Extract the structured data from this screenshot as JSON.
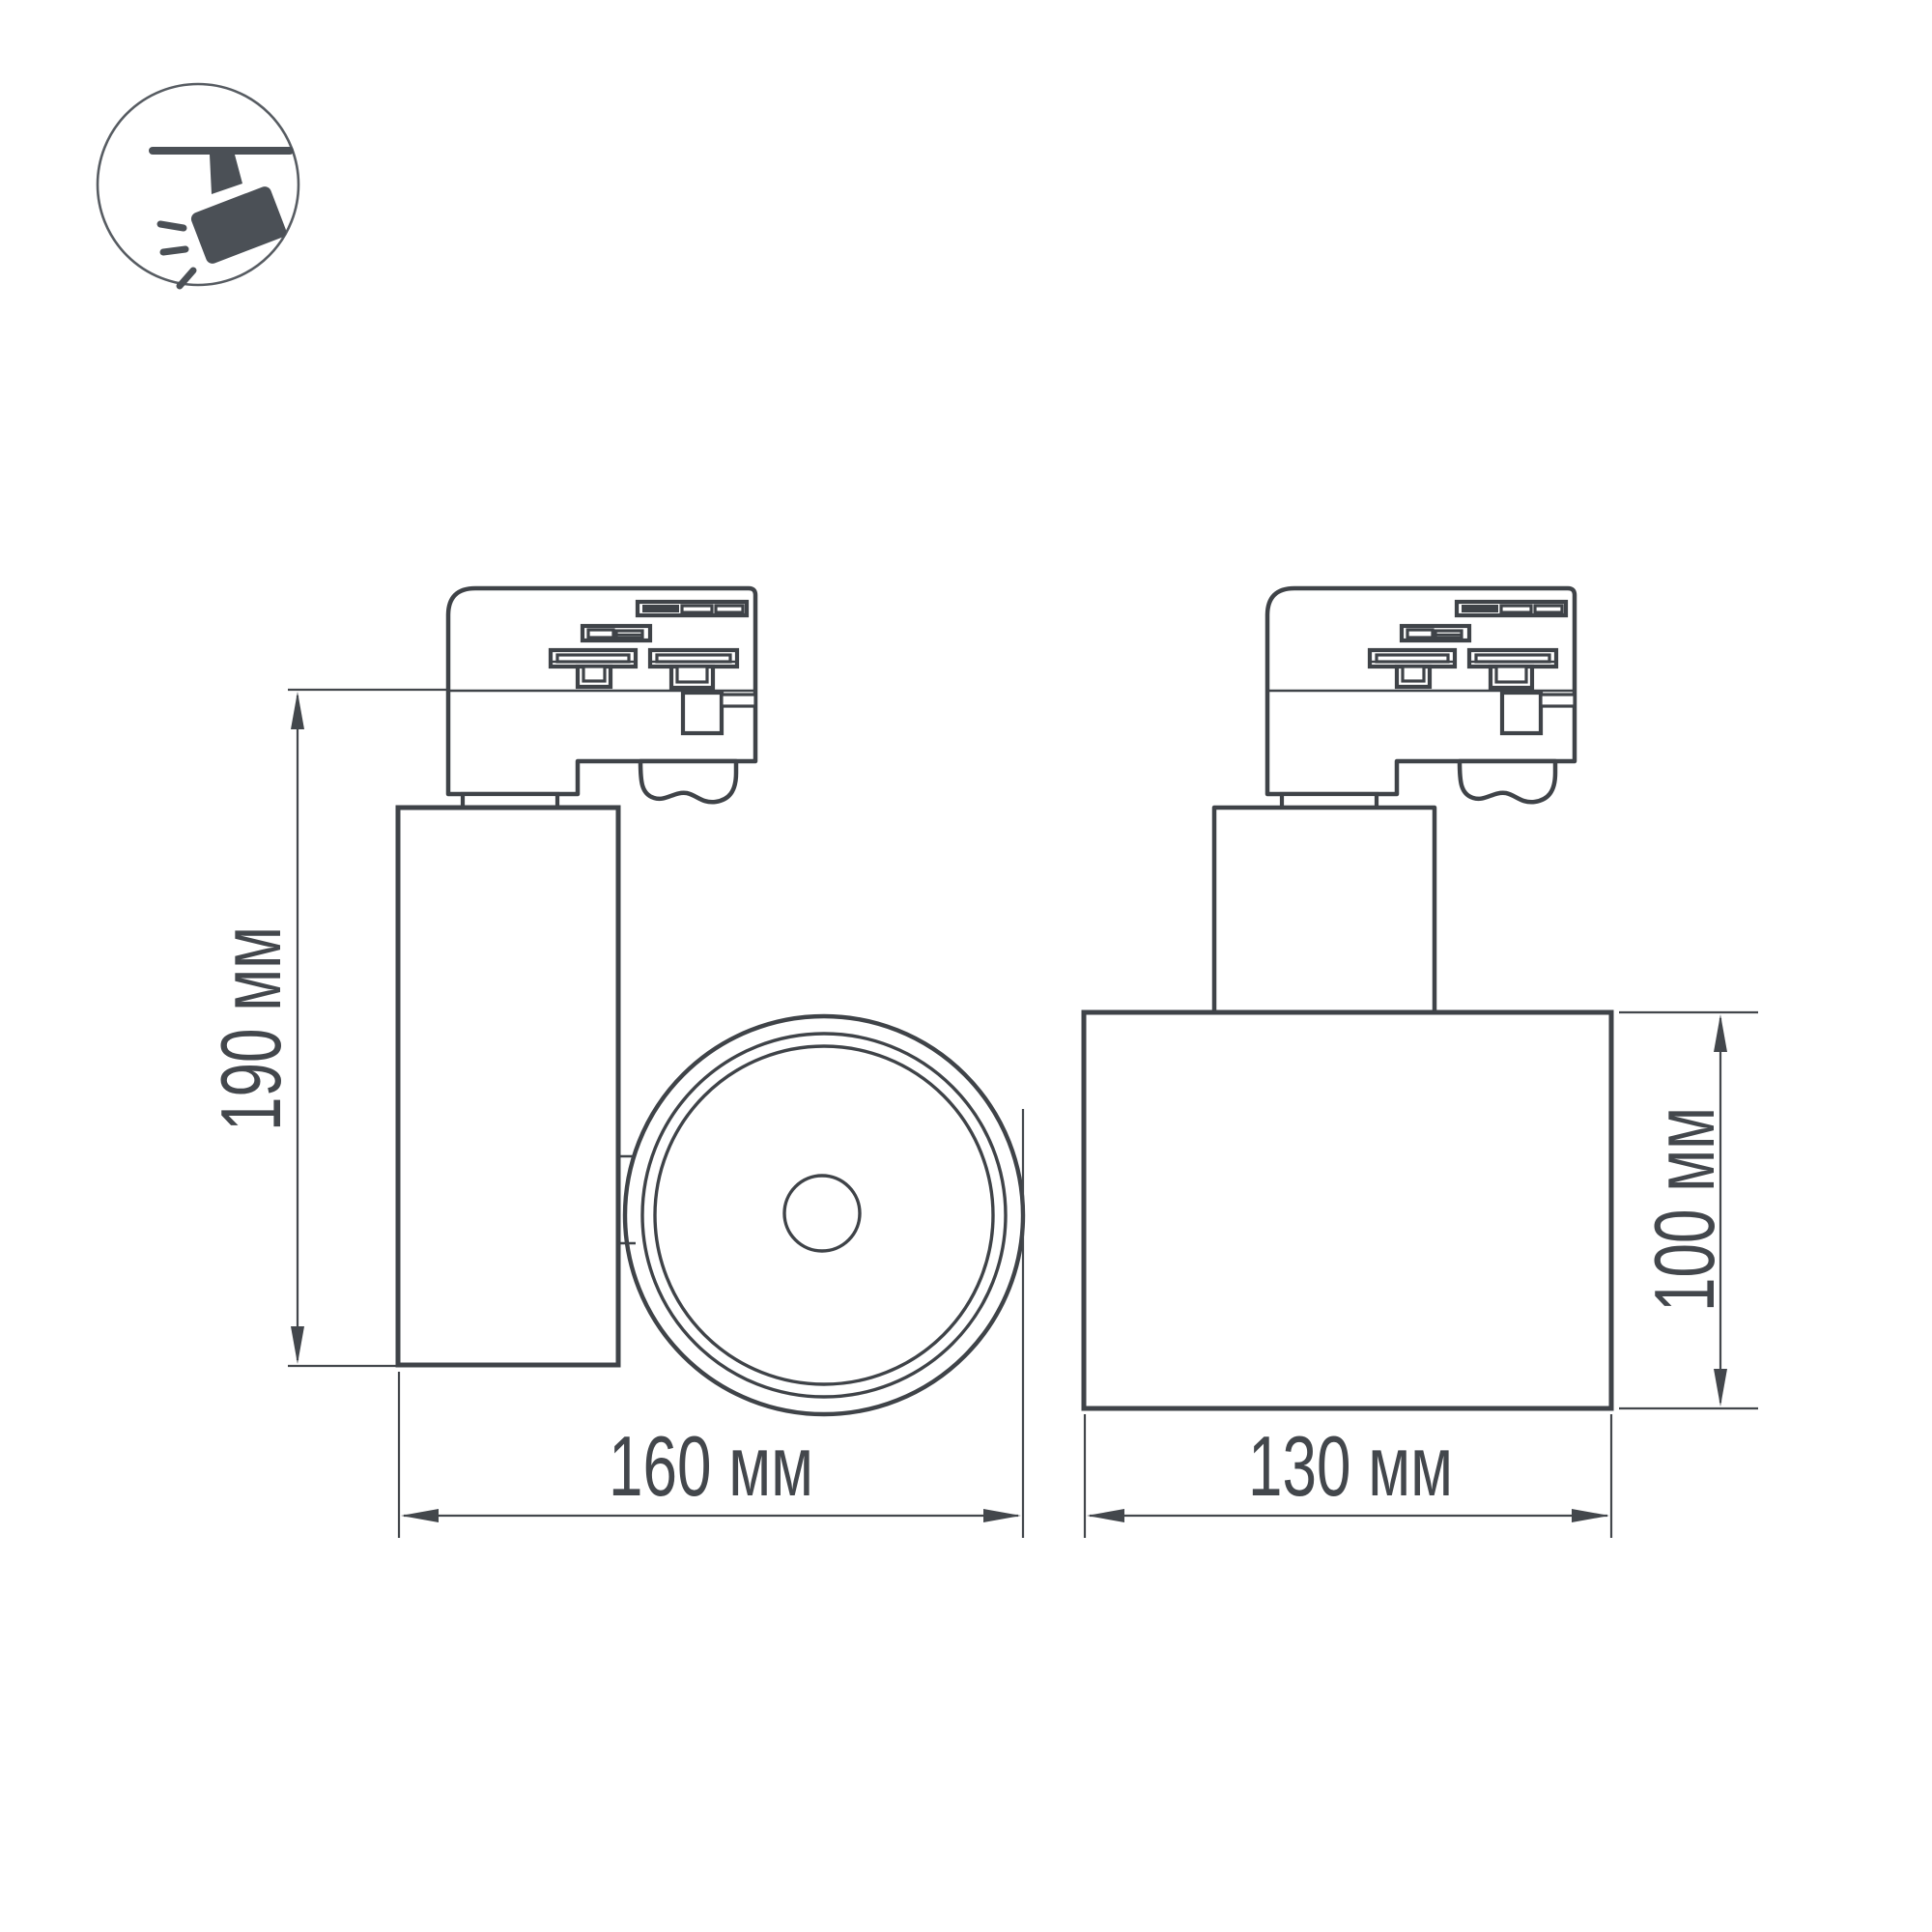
{
  "icon": {
    "name": "track-spotlight-icon"
  },
  "views": {
    "side_view": {
      "height_label": "190 мм",
      "width_label": "160 мм"
    },
    "front_view": {
      "height_label": "100 мм",
      "width_label": "130 мм"
    }
  },
  "colors": {
    "background": "#ffffff",
    "line": "#3f4348",
    "text": "#43474c",
    "icon": "#4b5056",
    "icon_circle_stroke": "#575c62"
  }
}
